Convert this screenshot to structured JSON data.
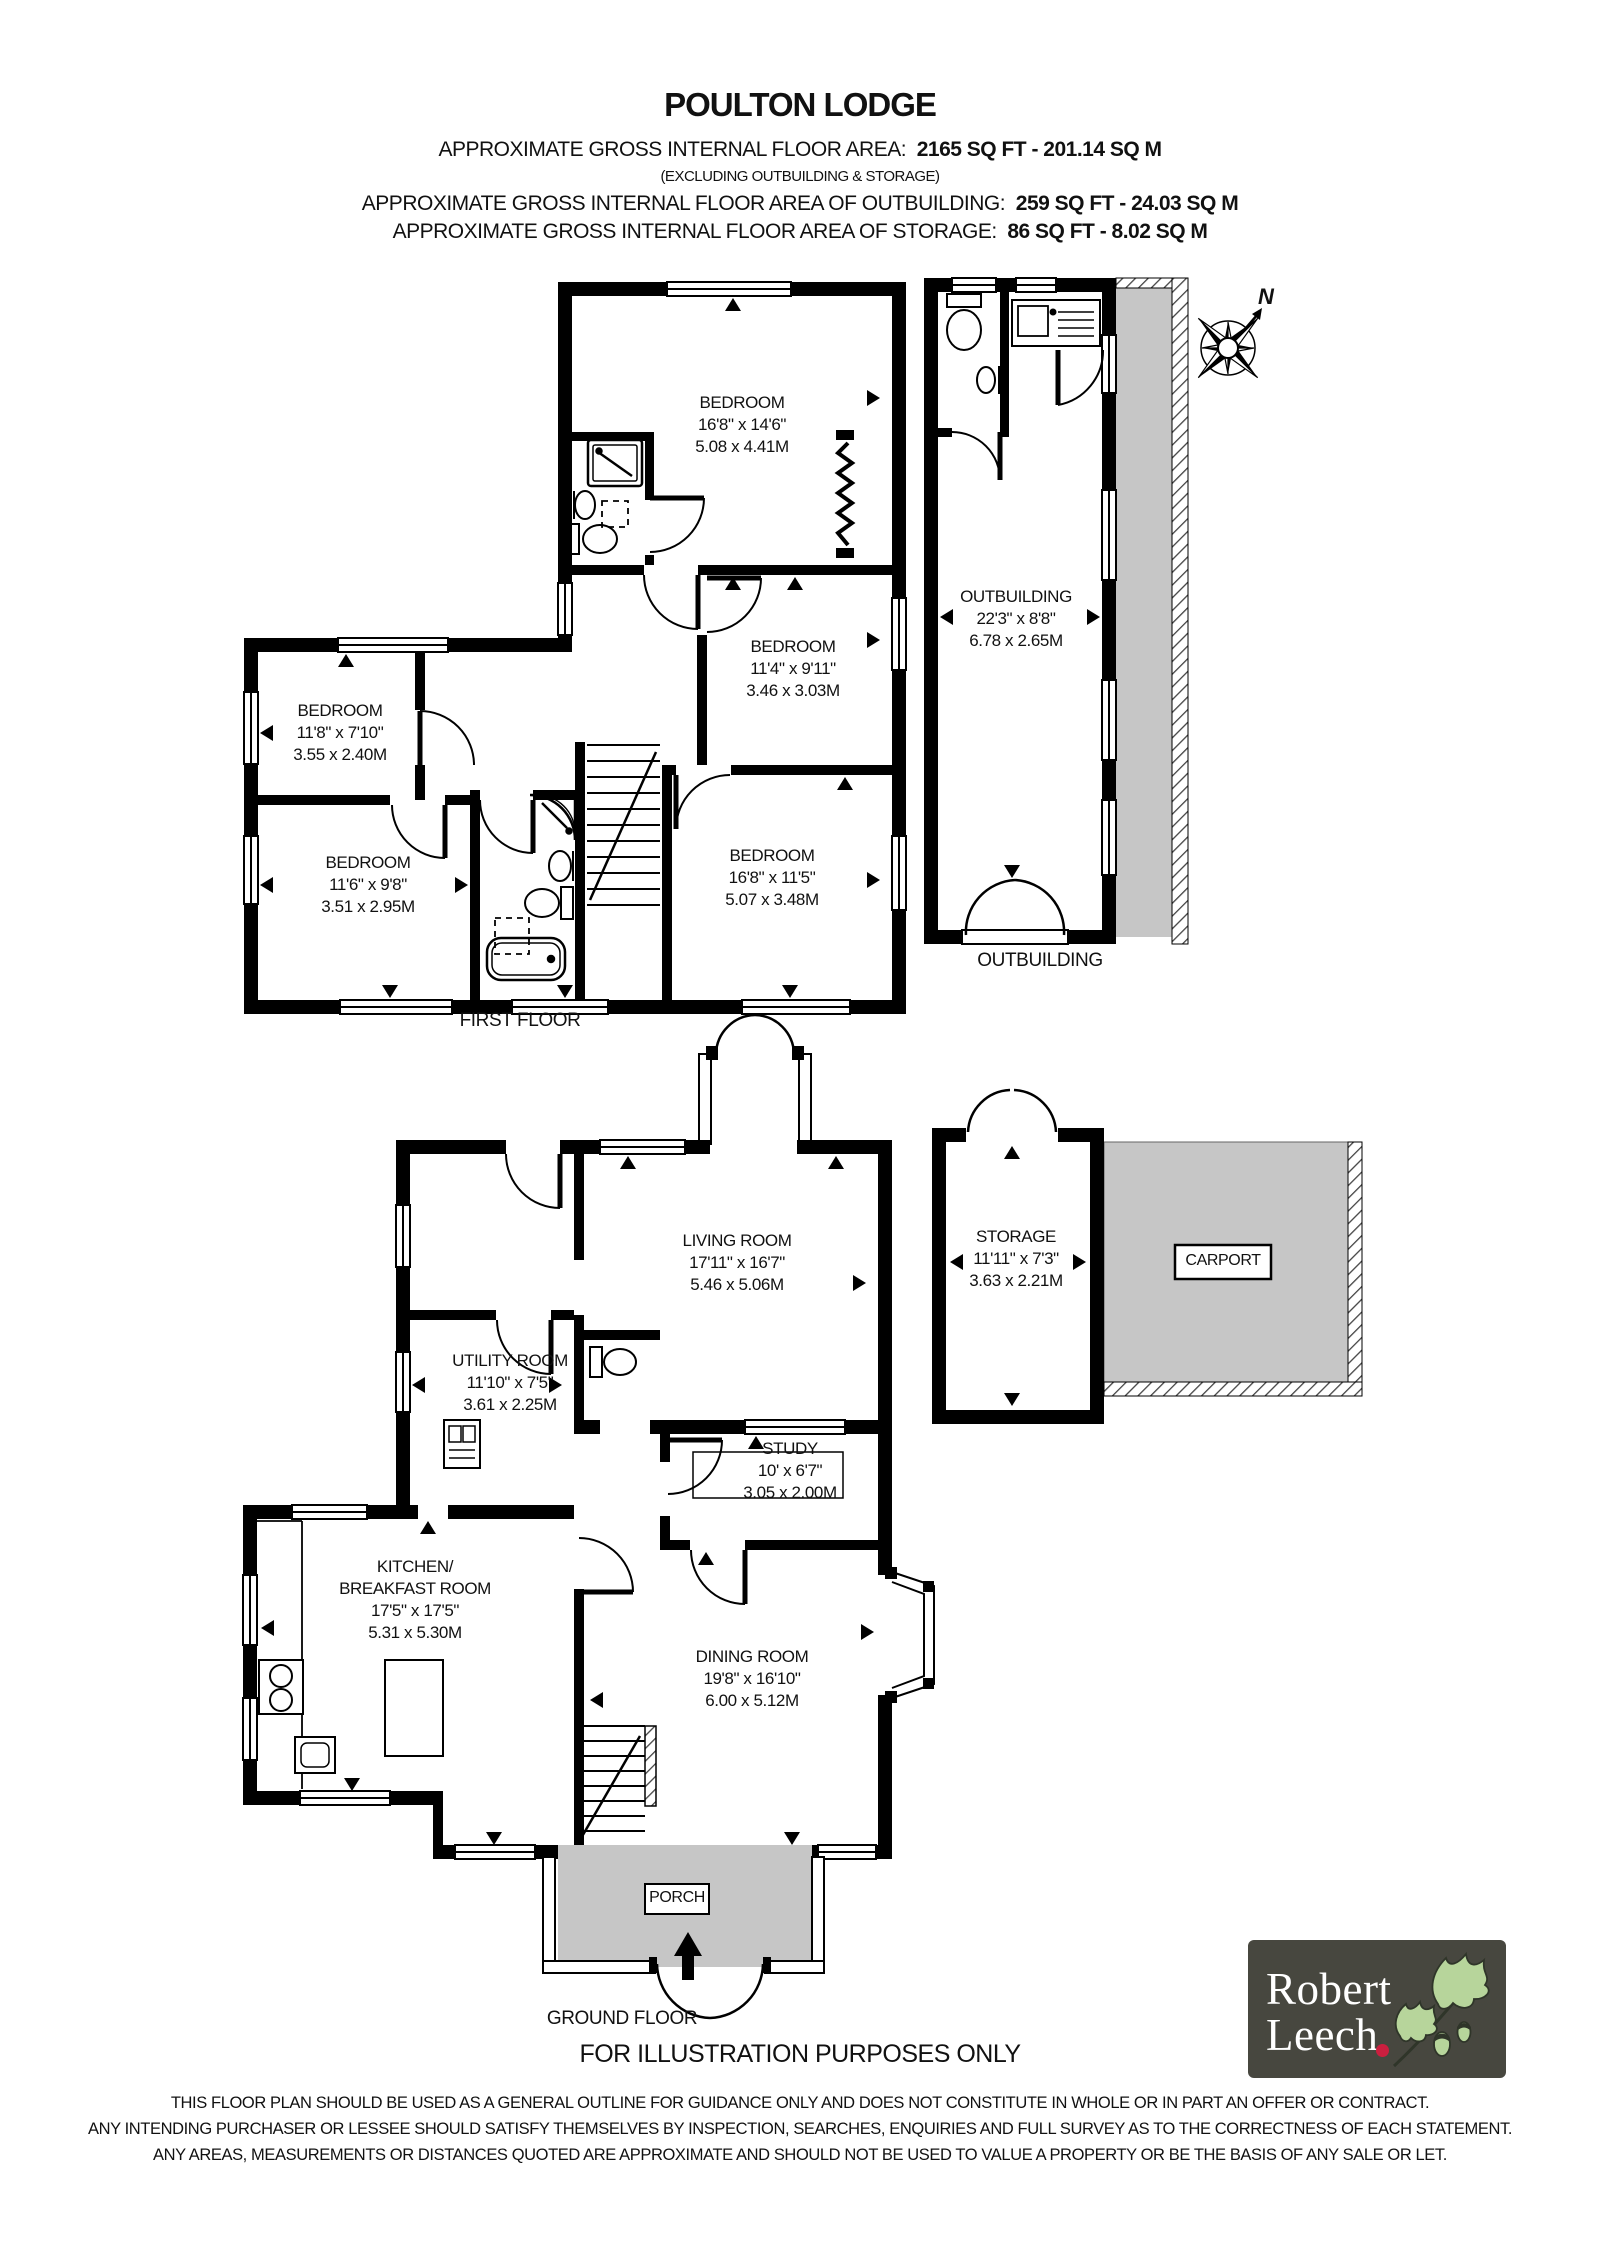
{
  "header": {
    "title": "POULTON LODGE",
    "area_label": "APPROXIMATE GROSS INTERNAL FLOOR AREA:",
    "area_value": "2165 SQ FT  -  201.14 SQ M",
    "area_note": "(EXCLUDING OUTBUILDING & STORAGE)",
    "outbuilding_label": "APPROXIMATE GROSS INTERNAL FLOOR AREA OF OUTBUILDING:",
    "outbuilding_value": "259 SQ FT  -  24.03 SQ M",
    "storage_label": "APPROXIMATE GROSS INTERNAL FLOOR AREA OF STORAGE:",
    "storage_value": "86 SQ FT  -  8.02 SQ M"
  },
  "rooms": [
    {
      "name": "BEDROOM",
      "imperial": "16'8\" x 14'6\"",
      "metric": "5.08 x 4.41M"
    },
    {
      "name": "BEDROOM",
      "imperial": "11'4\" x 9'11\"",
      "metric": "3.46 x 3.03M"
    },
    {
      "name": "BEDROOM",
      "imperial": "11'8\" x 7'10\"",
      "metric": "3.55 x 2.40M"
    },
    {
      "name": "BEDROOM",
      "imperial": "11'6\" x 9'8\"",
      "metric": "3.51 x 2.95M"
    },
    {
      "name": "BEDROOM",
      "imperial": "16'8\" x 11'5\"",
      "metric": "5.07 x 3.48M"
    },
    {
      "name": "OUTBUILDING",
      "imperial": "22'3\" x 8'8\"",
      "metric": "6.78 x 2.65M"
    },
    {
      "name": "LIVING ROOM",
      "imperial": "17'11\" x 16'7\"",
      "metric": "5.46 x 5.06M"
    },
    {
      "name": "UTILITY ROOM",
      "imperial": "11'10\" x 7'5\"",
      "metric": "3.61 x 2.25M"
    },
    {
      "name": "STUDY",
      "imperial": "10' x 6'7\"",
      "metric": "3.05 x 2.00M"
    },
    {
      "name": "KITCHEN/",
      "name2": "BREAKFAST ROOM",
      "imperial": "17'5\" x 17'5\"",
      "metric": "5.31 x 5.30M"
    },
    {
      "name": "DINING ROOM",
      "imperial": "19'8\" x 16'10\"",
      "metric": "6.00 x 5.12M"
    },
    {
      "name": "STORAGE",
      "imperial": "11'11\" x 7'3\"",
      "metric": "3.63 x 2.21M"
    }
  ],
  "captions": {
    "first_floor": "FIRST FLOOR",
    "ground_floor": "GROUND FLOOR",
    "outbuilding": "OUTBUILDING",
    "porch": "PORCH",
    "carport": "CARPORT",
    "illustration": "FOR ILLUSTRATION PURPOSES ONLY"
  },
  "compass": {
    "north_label": "N"
  },
  "disclaimer": {
    "line1": "THIS FLOOR PLAN SHOULD BE USED AS A GENERAL OUTLINE FOR GUIDANCE ONLY AND DOES NOT CONSTITUTE IN WHOLE OR IN PART AN OFFER OR CONTRACT.",
    "line2": "ANY INTENDING PURCHASER OR LESSEE SHOULD SATISFY THEMSELVES BY INSPECTION, SEARCHES, ENQUIRIES AND FULL SURVEY AS TO THE CORRECTNESS OF EACH STATEMENT.",
    "line3": "ANY AREAS, MEASUREMENTS OR DISTANCES QUOTED ARE APPROXIMATE AND SHOULD NOT BE USED TO VALUE A PROPERTY OR BE THE BASIS OF ANY SALE OR LET."
  },
  "logo": {
    "name_line1": "Robert",
    "name_line2": "Leech"
  },
  "colors": {
    "walls": "#000000",
    "paved_area": "#c6c6c6",
    "logo_background": "#47473f",
    "logo_accent_dot": "#cb1f3f",
    "logo_leaf_green": "#b7d59b"
  }
}
